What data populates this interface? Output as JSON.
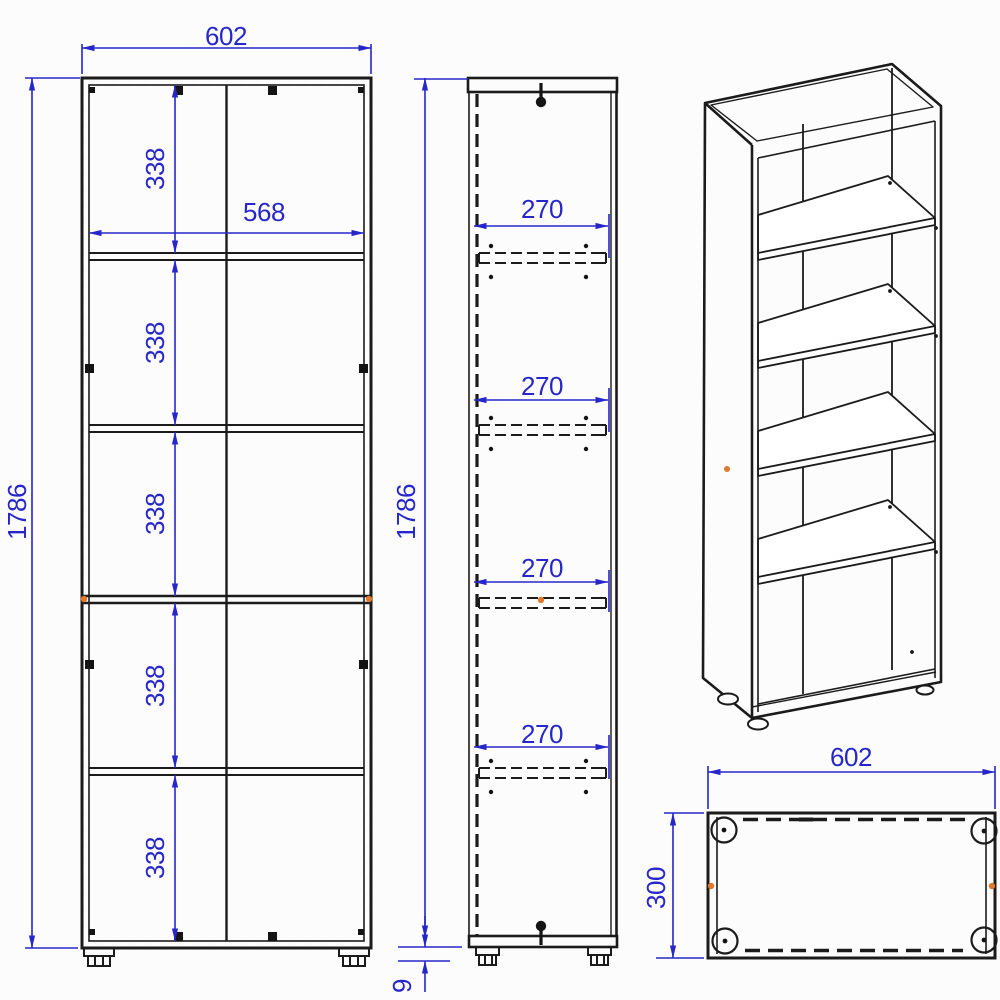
{
  "colors": {
    "dimension_blue": "#2626c9",
    "drawing_black": "#1b1b1b",
    "accent_orange": "#e0792e",
    "background": "#fcfcfd"
  },
  "front_view": {
    "width": "602",
    "inner_width": "568",
    "height": "1786",
    "section_heights": [
      "338",
      "338",
      "338",
      "338",
      "338"
    ]
  },
  "side_view": {
    "height": "1786",
    "shelf_depths": [
      "270",
      "270",
      "270",
      "270"
    ],
    "base_height": "9"
  },
  "top_view": {
    "width": "602",
    "depth": "300"
  }
}
